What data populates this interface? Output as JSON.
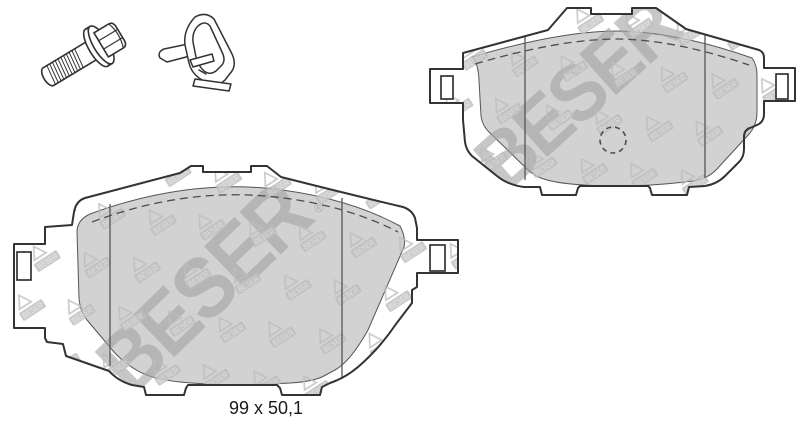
{
  "brand": {
    "name": "BESER",
    "registered_mark": "®"
  },
  "label": {
    "pad_dimensions": "99 x 50,1"
  },
  "colors": {
    "background": "#ffffff",
    "outline": "#333333",
    "friction_surface": "#d2d2d2",
    "watermark": "#bdbdbd",
    "watermark_text": "#dadada",
    "watermark_large": "#a2a2a2",
    "hidden_line": "#4d4d4d",
    "label_text": "#1a1a1a"
  },
  "parts": {
    "bolt": "flange-bolt",
    "clip": "retaining-clip",
    "pad_large": "brake-pad-large",
    "pad_small": "brake-pad-small"
  }
}
